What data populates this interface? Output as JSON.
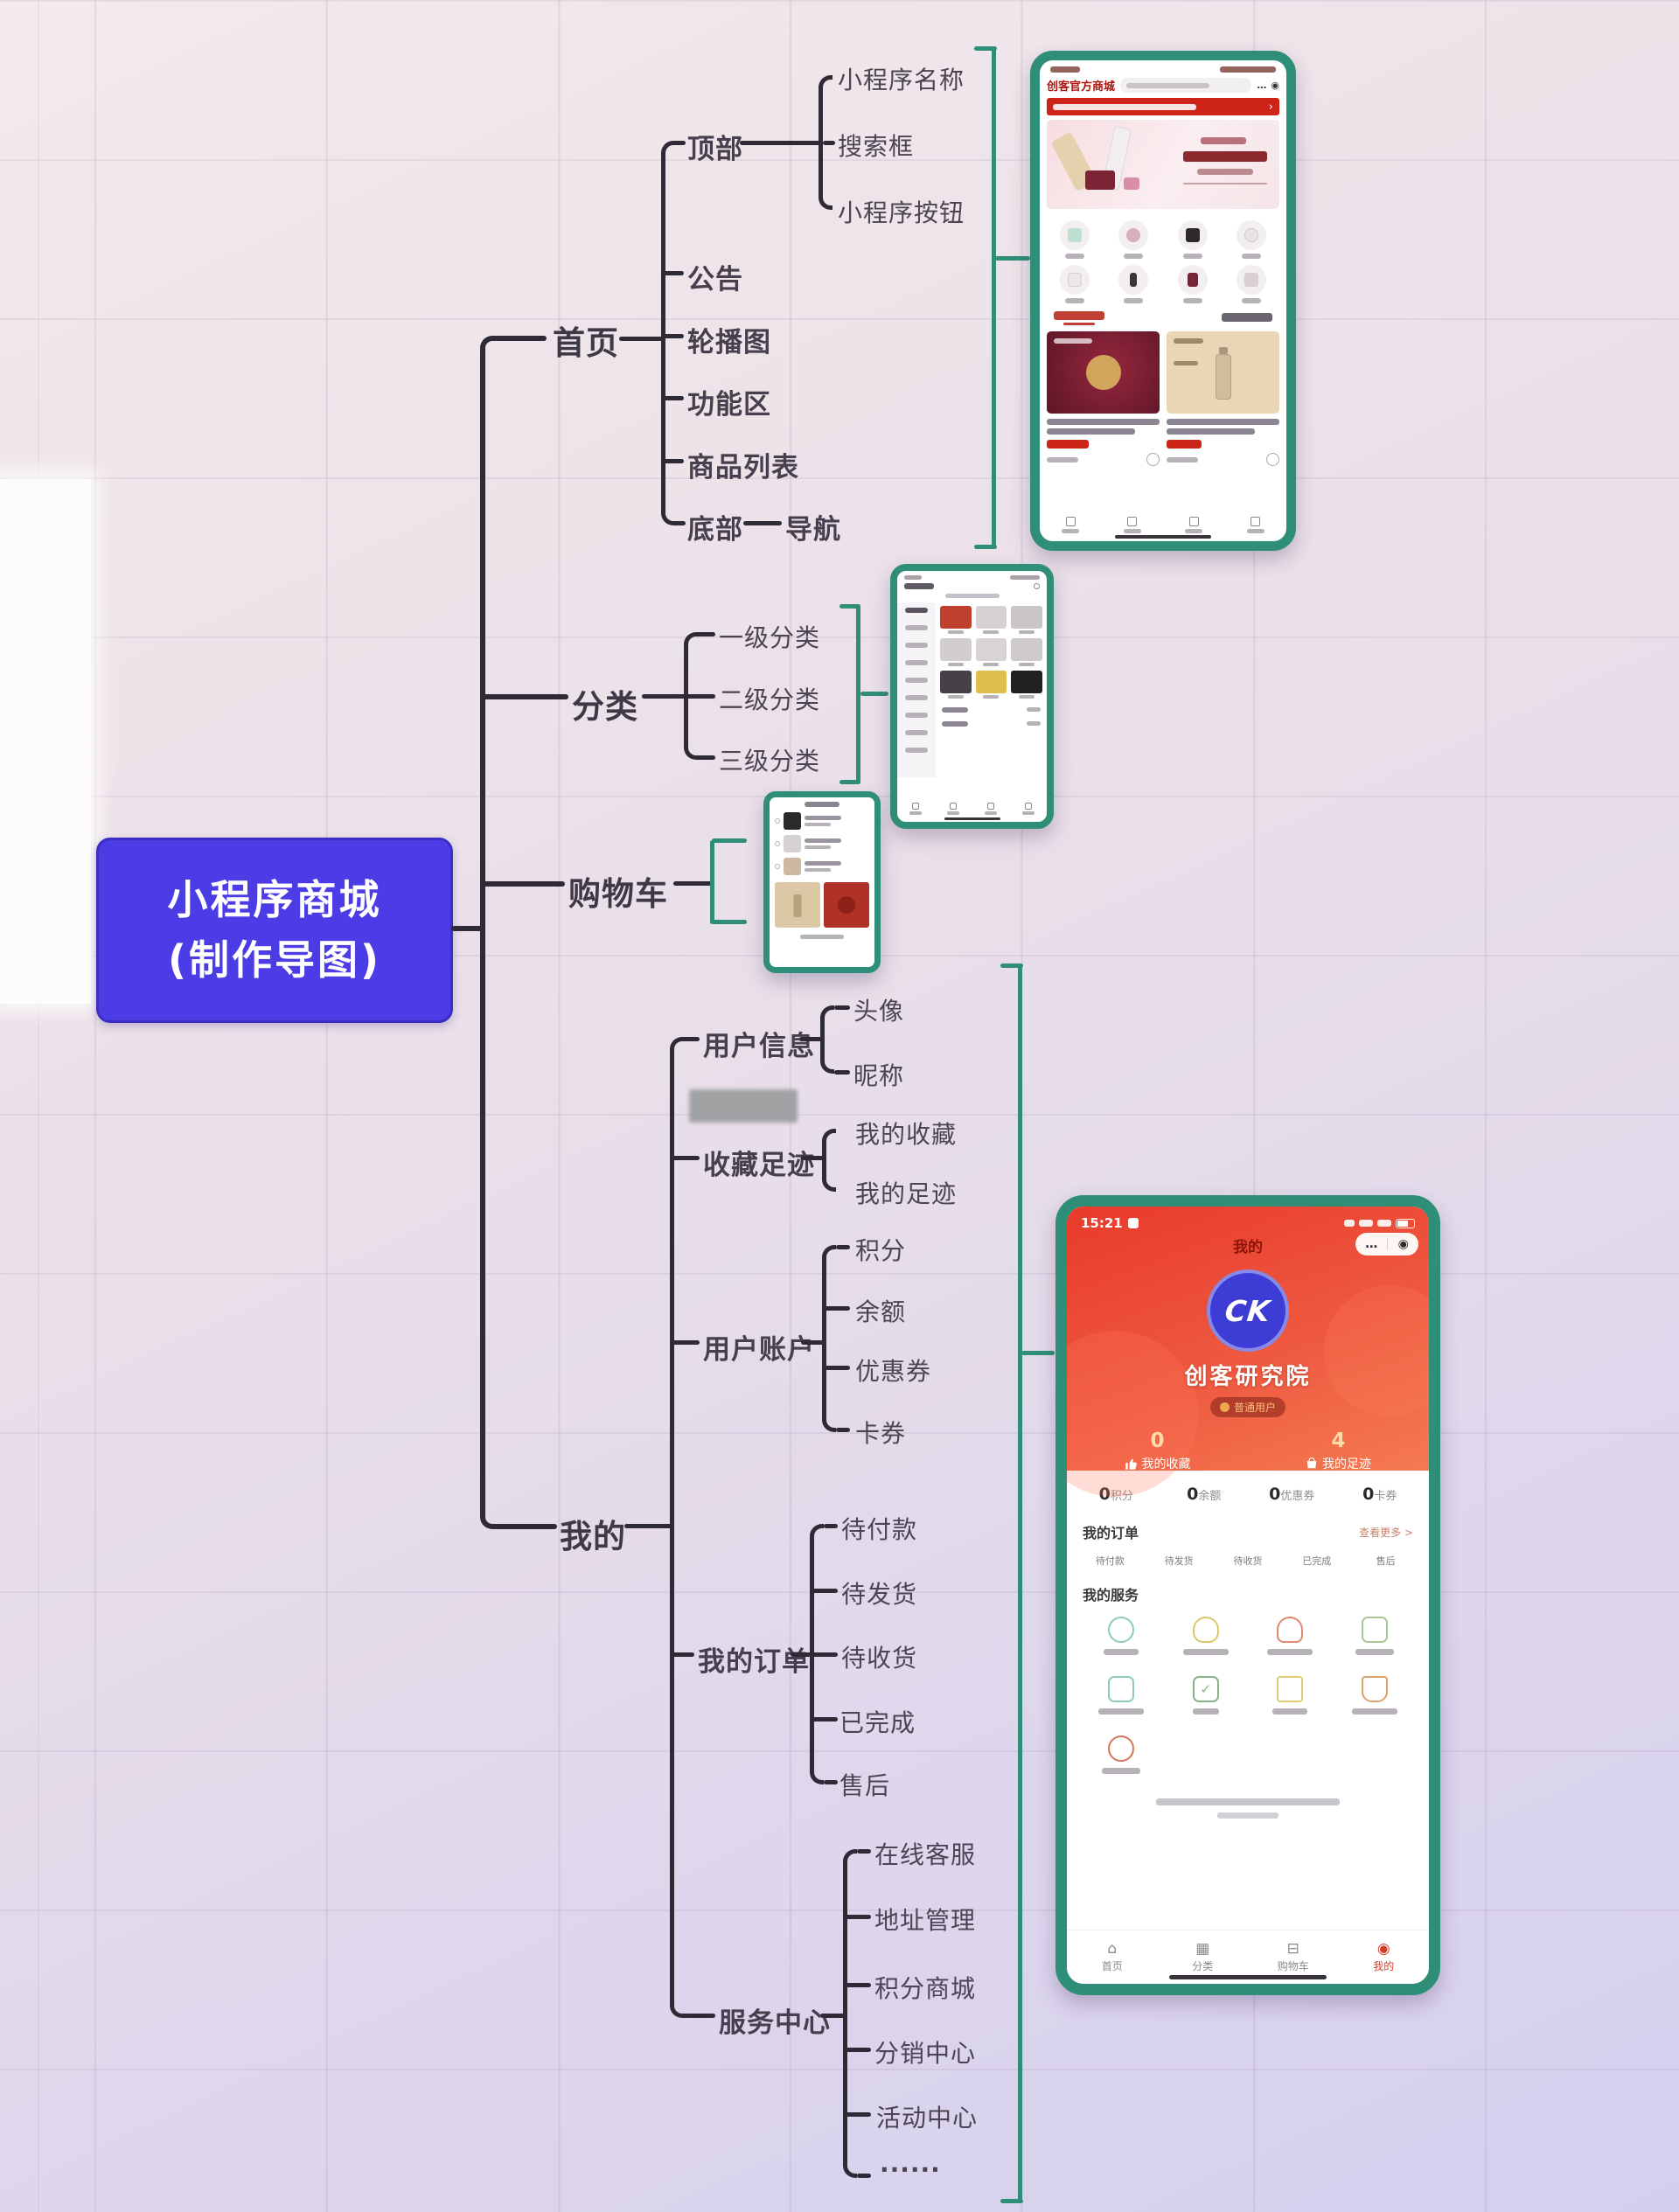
{
  "colors": {
    "teal_frame": "#2f8e77",
    "root_bg": "#4b3ce6",
    "line": "#2e2a36",
    "app_red": "#e93a2b",
    "notice_red": "#ce2418"
  },
  "root": {
    "line1": "小程序商城",
    "line2": "(制作导图)"
  },
  "tree": {
    "home": {
      "label": "首页",
      "top": {
        "label": "顶部",
        "name": "小程序名称",
        "search": "搜索框",
        "button": "小程序按钮"
      },
      "notice": "公告",
      "carousel": "轮播图",
      "features": "功能区",
      "products": "商品列表",
      "bottom": {
        "label": "底部",
        "nav": "导航"
      }
    },
    "category": {
      "label": "分类",
      "level1": "一级分类",
      "level2": "二级分类",
      "level3": "三级分类"
    },
    "cart": {
      "label": "购物车"
    },
    "mine": {
      "label": "我的",
      "user_info": {
        "label": "用户信息",
        "avatar": "头像",
        "nickname": "昵称"
      },
      "favorites": {
        "label": "收藏足迹",
        "my_fav": "我的收藏",
        "my_footprint": "我的足迹"
      },
      "account": {
        "label": "用户账户",
        "points": "积分",
        "balance": "余额",
        "coupon": "优惠券",
        "card": "卡券"
      },
      "orders": {
        "label": "我的订单",
        "unpaid": "待付款",
        "to_ship": "待发货",
        "to_receive": "待收货",
        "completed": "已完成",
        "after_sale": "售后"
      },
      "service": {
        "label": "服务中心",
        "online": "在线客服",
        "address": "地址管理",
        "points_mall": "积分商城",
        "distribution": "分销中心",
        "activity": "活动中心",
        "more": "......"
      }
    }
  },
  "phones": {
    "home": {
      "brand": "创客官方商城",
      "capsule": {
        "more": "…",
        "target": "◉"
      },
      "notice_arrow": "›"
    },
    "profile": {
      "status_time": "15:21",
      "nav_title": "我的",
      "capsule": {
        "more": "…",
        "target": "◉"
      },
      "logo_text": "CK",
      "brand": "创客研究院",
      "badge": "普通用户",
      "stats": [
        {
          "value": "0",
          "label": "我的收藏"
        },
        {
          "value": "4",
          "label": "我的足迹"
        }
      ],
      "wallet": [
        {
          "value": "0",
          "label": "积分"
        },
        {
          "value": "0",
          "label": "余额"
        },
        {
          "value": "0",
          "label": "优惠券"
        },
        {
          "value": "0",
          "label": "卡券"
        }
      ],
      "orders_title": "我的订单",
      "orders_more": "查看更多 >",
      "orders": [
        "待付款",
        "待发货",
        "待收货",
        "已完成",
        "售后"
      ],
      "service_title": "我的服务",
      "tabs": [
        {
          "icon": "⌂",
          "label": "首页"
        },
        {
          "icon": "▦",
          "label": "分类"
        },
        {
          "icon": "⊟",
          "label": "购物车"
        },
        {
          "icon": "◉",
          "label": "我的"
        }
      ]
    }
  }
}
